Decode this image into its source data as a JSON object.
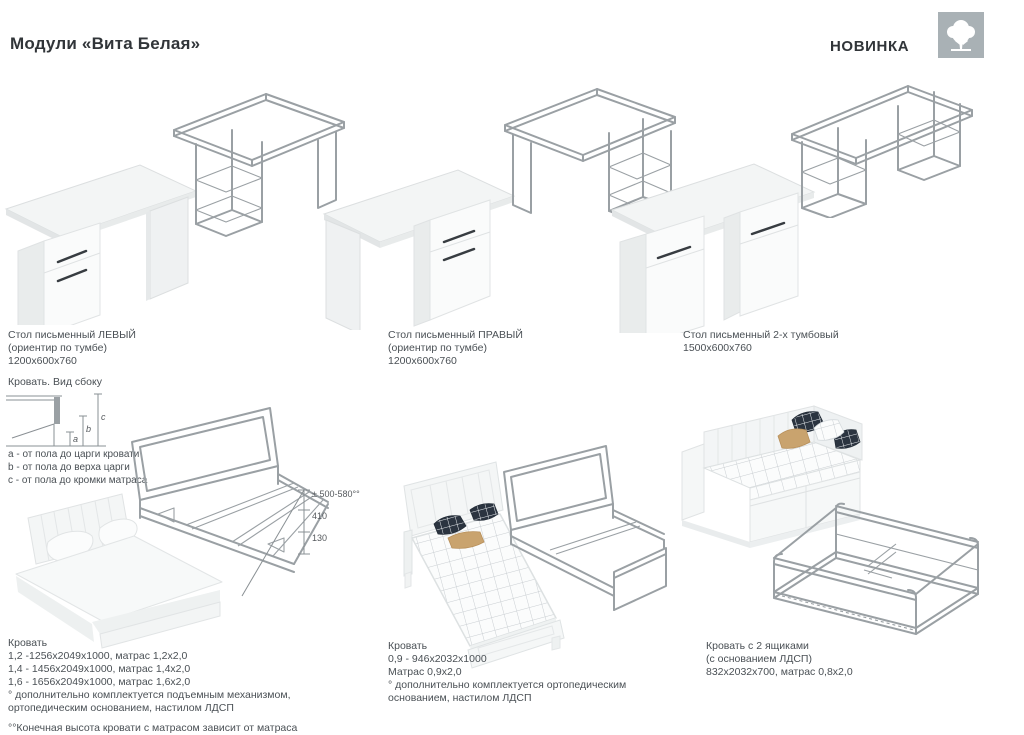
{
  "header": {
    "title": "Модули «Вита Белая»",
    "badge": "НОВИНКА"
  },
  "desks": [
    {
      "lines": [
        "Стол письменный ЛЕВЫЙ",
        "(ориентир по тумбе)",
        "1200x600x760"
      ]
    },
    {
      "lines": [
        "Стол письменный ПРАВЫЙ",
        "(ориентир по тумбе)",
        "1200x600x760"
      ]
    },
    {
      "lines": [
        "Стол письменный 2-х тумбовый",
        "1500x600x760"
      ]
    }
  ],
  "side_view": {
    "title": "Кровать. Вид сбоку",
    "marks": [
      "a",
      "b",
      "c"
    ],
    "legend": [
      "а - от пола до царги кровати",
      "b - от пола до верха царги",
      "с - от пола до кромки матраса"
    ]
  },
  "bed_double": {
    "title": "Кровать",
    "size_lines": [
      "1,2 -1256x2049x1000, матрас 1,2x2,0",
      "1,4 - 1456x2049x1000, матрас 1,4x2,0",
      "1,6 - 1656x2049x1000, матрас 1,6x2,0"
    ],
    "footnote_lines": [
      "° дополнительно комплектуется подъемным механизмом,",
      "ортопедическим основанием, настилом ЛДСП"
    ],
    "footnote2": "°°Конечная высота кровати с матрасом зависит от матраса",
    "dims": [
      "± 500-580°°",
      "410",
      "130"
    ]
  },
  "bed_single": {
    "title": "Кровать",
    "size_lines": [
      "0,9 - 946x2032x1000",
      "Матрас 0,9x2,0"
    ],
    "footnote_lines": [
      "° дополнительно комплектуется ортопедическим",
      "основанием, настилом ЛДСП"
    ]
  },
  "bed_drawers": {
    "title": "Кровать с 2 ящиками",
    "size_lines": [
      "(с основанием ЛДСП)",
      "832x2032x700, матрас 0,8x2,0"
    ]
  },
  "colors": {
    "wireframe": "#9aa0a4",
    "logo_bg": "#a9b1b5",
    "text": "#4a5055",
    "handle": "#373c41",
    "pillow_navy": "#2b3440",
    "pillow_tan": "#c9a36e"
  }
}
